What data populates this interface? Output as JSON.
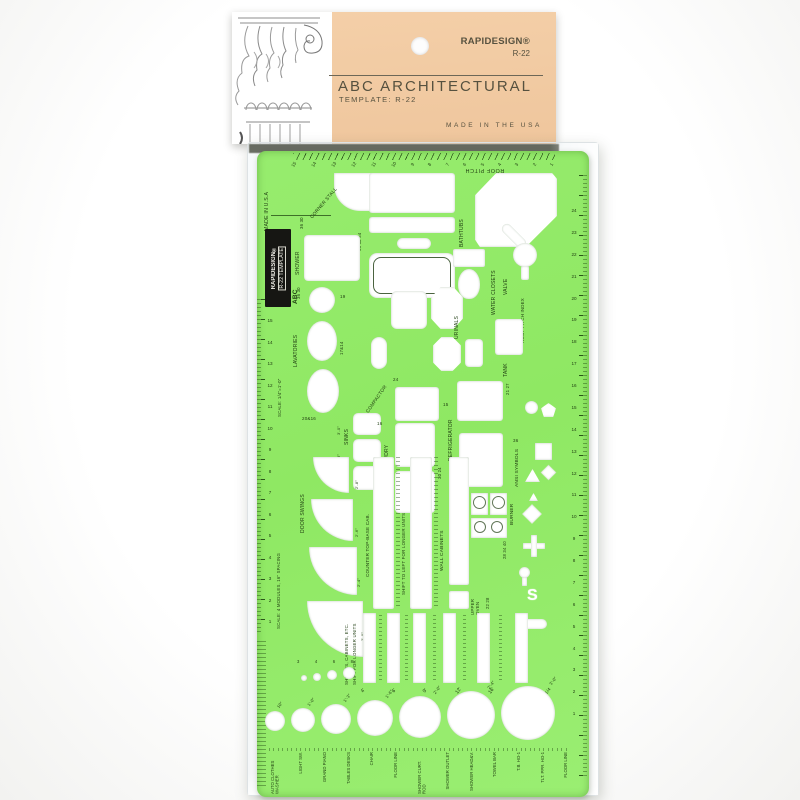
{
  "header": {
    "brand": "RAPIDESIGN®",
    "model": "R-22",
    "title": "ABC Architectural",
    "subtitle": "Template: R-22",
    "made_in": "MADE IN THE USA",
    "column_icon": "corinthian-column-engraving",
    "colors": {
      "card": "#f4cfa8",
      "text": "#56513f"
    }
  },
  "template": {
    "colors": {
      "plastic": "#8fe863",
      "print": "#1e3c10",
      "badge_bg": "#161613",
      "badge_text": "#efeee6"
    },
    "badge": {
      "line1": "RAPIDESIGN®",
      "line2": "R-22  TEMPLATE",
      "line3": "ABC"
    },
    "edge": {
      "made_in": "MADE IN U.S.A",
      "roof_pitch": "ROOF PITCH",
      "scale_quarter": "SCALE: 1/4\"=1'-0\"",
      "scale_modules": "SCALE: 4 MODULES, 16\" SPACING",
      "fraction_note": "1/4"
    },
    "rulers": {
      "top": [
        "15",
        "14",
        "13",
        "12",
        "11",
        "10",
        "9",
        "8",
        "7",
        "6",
        "5",
        "4",
        "3",
        "2",
        "1"
      ],
      "left": [
        "15",
        "14",
        "13",
        "12",
        "11",
        "10",
        "9",
        "8",
        "7",
        "6",
        "5",
        "4",
        "3",
        "2",
        "1"
      ],
      "right": [
        "24",
        "23",
        "22",
        "21",
        "20",
        "19",
        "18",
        "17",
        "16",
        "15",
        "14",
        "13",
        "12",
        "11",
        "10",
        "9",
        "8",
        "7",
        "6",
        "5",
        "4",
        "3",
        "2",
        "1"
      ]
    },
    "sections": {
      "corner_stall": {
        "label": "CORNER STALL",
        "sizes": "36 30"
      },
      "bathtubs": {
        "label": "BATHTUBS",
        "sizes": "66 60 54"
      },
      "shower": {
        "label": "SHOWER",
        "sizes": "36 30"
      },
      "lavatories": {
        "label": "LAVATORIES",
        "sizes": [
          "19",
          "17&14",
          "20&16"
        ]
      },
      "urinals": {
        "label": "URINALS"
      },
      "water_closets": {
        "label": "WATER CLOSETS"
      },
      "valve": {
        "label": "VALVE"
      },
      "tank": {
        "label": "TANK"
      },
      "roof_pitch_index": {
        "label": "ROOF PITCH INDEX"
      },
      "compactor": {
        "label": "COMPACTOR",
        "sizes": [
          "24",
          "15"
        ]
      },
      "refrigerator": {
        "label": "REFRIGERATOR",
        "sizes": "21 27"
      },
      "sinks": {
        "label": "SINKS",
        "sizes": [
          "3'-0\"",
          "2'-8\"",
          "2'-6\""
        ]
      },
      "wash_dry": {
        "label": "WASH/DRY",
        "sizes": [
          "16",
          "12",
          "30 24"
        ]
      },
      "ranges": {
        "label": "RANGES"
      },
      "burner": {
        "label": "BURNER",
        "sizes": "28 34 40"
      },
      "ansi_symbols": {
        "label": "ANSI SYMBOLS",
        "sizes": "36",
        "s_glyph": "S"
      },
      "door_swings": {
        "label": "DOOR SWINGS",
        "sizes": [
          "2'-8\"",
          "2'-6\"",
          "2'-4\"",
          "2'-0\""
        ]
      },
      "counter": {
        "label": "COUNTER TOP-BASE CAB."
      },
      "shift_left": {
        "label": "SHIFT TO LEFT FOR LONGER UNITS"
      },
      "wall_cabinets": {
        "label": "WALL CABINETS"
      },
      "upper_oven": {
        "label": "UPPER OVEN",
        "sizes": "22 28"
      },
      "shelves": {
        "label": "SHELVES, CABINETS, ETC.",
        "label2": "SHIFT FOR LONGER UNITS",
        "widths": [
          "4'",
          "6'",
          "9'",
          "12'",
          "16'",
          "20'"
        ]
      },
      "circles": {
        "sizes": [
          "10\"",
          "1'-0\"",
          "1'-3\"",
          "1'-6\"",
          "2'-0\"",
          "2'-4\"",
          "3'-0\""
        ],
        "small_sizes": [
          "3",
          "4",
          "6",
          "8"
        ]
      },
      "bottom_row": {
        "labels": [
          "AUTO CLOTHES WASHER",
          "LIGHT SW.",
          "GRAND PIANO",
          "TABLES DESKS",
          "CHAIR",
          "FLOOR LINE",
          "SHOWER CURT. ROD",
          "SHOWER OUTLET",
          "SHOWER HEAD&V.",
          "TOWEL BAR",
          "T.B. HO-1",
          "TLT. PPR. HO-1",
          "FLOOR LINE"
        ]
      }
    }
  }
}
